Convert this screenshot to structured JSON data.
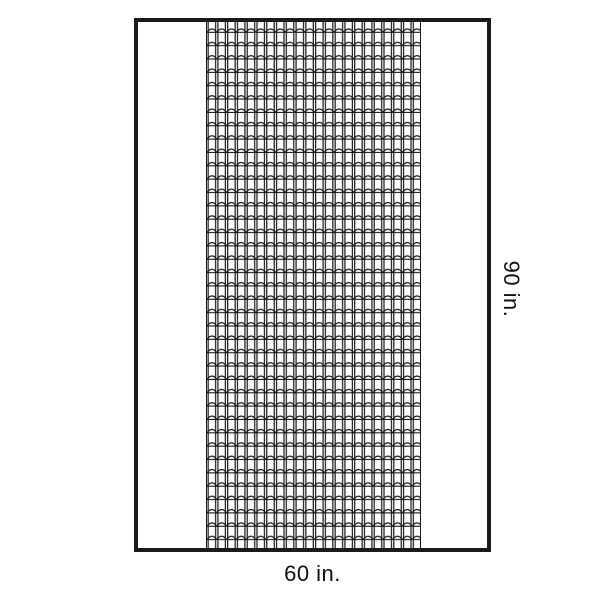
{
  "diagram": {
    "width_label": "60 in.",
    "height_label": "90 in.",
    "pattern_name": "scallop-grid-pattern"
  },
  "colors": {
    "background": "#ffffff",
    "outline": "#1a1a1a",
    "pattern_line": "#161616",
    "label_text": "#111111"
  }
}
